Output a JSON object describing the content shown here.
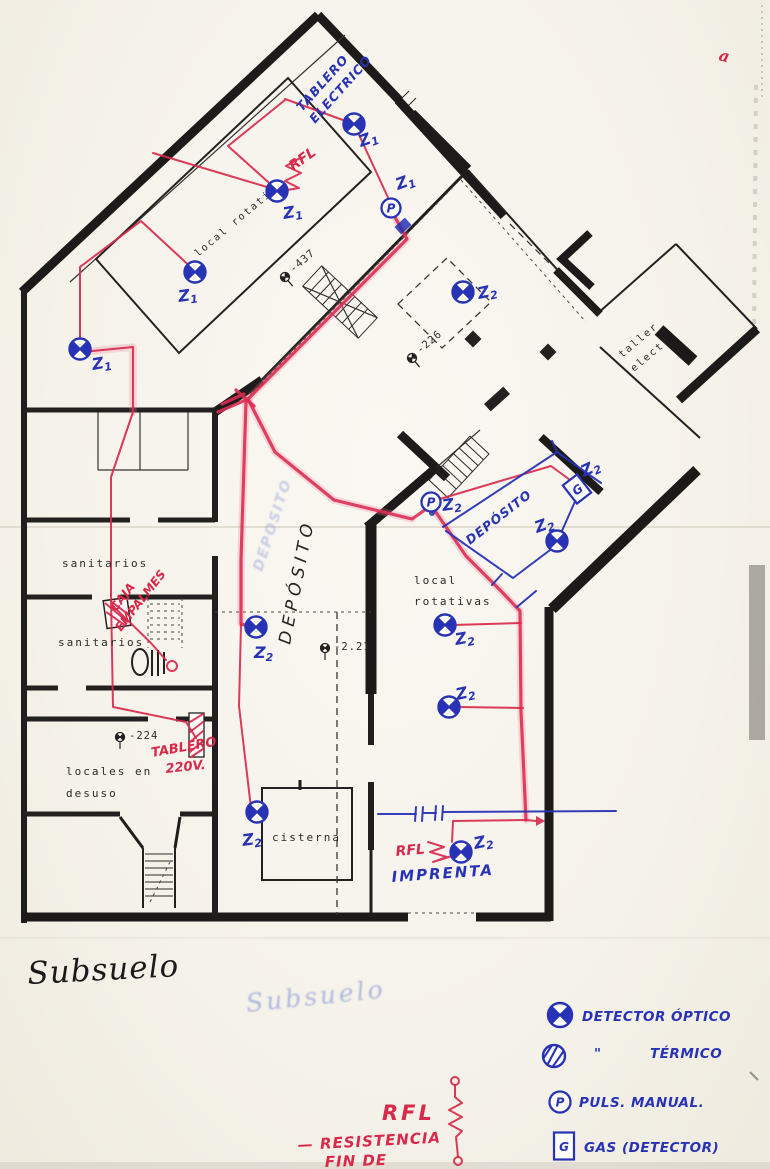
{
  "titles": {
    "main": "Subsuelo",
    "ghost": "Subsuelo",
    "corner_mark": "a"
  },
  "panel_notes": {
    "tablero_electrico_line1": "TABLERO",
    "tablero_electrico_line2": "ELECTRICO",
    "imprenta": "IMPRENTA",
    "deposito_blue": "DEPÓSITO",
    "deposito_black": "DEPÓSITO",
    "deposito_ghost": "DEPOSITO"
  },
  "rfl_note": {
    "symbol_label": "RFL",
    "line1": "— RESISTENCIA",
    "line2": "FIN DE"
  },
  "plan_labels": [
    {
      "text": "local rotativa",
      "x": 198,
      "y": 257,
      "rot": -40,
      "size": 10
    },
    {
      "text": "sanitarios",
      "x": 62,
      "y": 567,
      "size": 11
    },
    {
      "text": "sanitarios",
      "x": 58,
      "y": 646,
      "size": 11
    },
    {
      "text": "locales en",
      "x": 66,
      "y": 775,
      "size": 11
    },
    {
      "text": "desuso",
      "x": 66,
      "y": 797,
      "size": 11
    },
    {
      "text": "cisterna",
      "x": 272,
      "y": 841,
      "size": 11
    },
    {
      "text": "local",
      "x": 414,
      "y": 584,
      "size": 11
    },
    {
      "text": "rotativas",
      "x": 414,
      "y": 605,
      "size": 11
    },
    {
      "text": "taller",
      "x": 622,
      "y": 358,
      "rot": -40,
      "size": 10
    },
    {
      "text": "electr",
      "x": 634,
      "y": 372,
      "rot": -40,
      "size": 10
    }
  ],
  "level_markers": [
    {
      "text": "-437",
      "x": 285,
      "y": 277,
      "rot": -40
    },
    {
      "text": "-226",
      "x": 412,
      "y": 358,
      "rot": -40
    },
    {
      "text": "-2.21",
      "x": 325,
      "y": 648,
      "rot": 0
    },
    {
      "text": "-224",
      "x": 120,
      "y": 737,
      "rot": 0
    }
  ],
  "red_notes": [
    {
      "text": "RFL",
      "x": 293,
      "y": 171,
      "rot": -35,
      "size": 14
    },
    {
      "text": "CAJA",
      "x": 116,
      "y": 612,
      "rot": -52,
      "size": 12
    },
    {
      "text": "EMPALMES",
      "x": 121,
      "y": 632,
      "rot": -52,
      "size": 12
    },
    {
      "text": "TABLERO",
      "x": 152,
      "y": 757,
      "rot": -10,
      "size": 13
    },
    {
      "text": "220V.",
      "x": 166,
      "y": 773,
      "rot": -6,
      "size": 13
    },
    {
      "text": "RFL",
      "x": 396,
      "y": 856,
      "rot": -5,
      "size": 14
    }
  ],
  "detectors": [
    {
      "type": "optical",
      "zone": "Z1",
      "x": 354,
      "y": 124,
      "lx": 361,
      "ly": 147,
      "lrot": -20
    },
    {
      "type": "optical",
      "zone": "Z1",
      "x": 277,
      "y": 191,
      "lx": 284,
      "ly": 219,
      "lrot": -10
    },
    {
      "type": "optical",
      "zone": "Z1",
      "x": 195,
      "y": 272,
      "lx": 179,
      "ly": 302,
      "lrot": -8
    },
    {
      "type": "optical",
      "zone": "Z1",
      "x": 80,
      "y": 349,
      "lx": 93,
      "ly": 370,
      "lrot": -10
    },
    {
      "type": "pulsador",
      "zone": "Z1",
      "x": 391,
      "y": 208,
      "lx": 398,
      "ly": 190,
      "lrot": -20
    },
    {
      "type": "optical",
      "zone": "Z2",
      "x": 463,
      "y": 292,
      "lx": 479,
      "ly": 299,
      "lrot": -12
    },
    {
      "type": "pulsador",
      "zone": "Z2",
      "x": 431,
      "y": 502,
      "lx": 443,
      "ly": 511,
      "lrot": -8
    },
    {
      "type": "gas",
      "zone": "Z2",
      "x": 577,
      "y": 489,
      "rot": -38,
      "lx": 584,
      "ly": 477,
      "lrot": -25
    },
    {
      "type": "optical",
      "zone": "Z2",
      "x": 557,
      "y": 541,
      "lx": 537,
      "ly": 533,
      "lrot": -20
    },
    {
      "type": "optical",
      "zone": "Z2",
      "x": 256,
      "y": 627,
      "lx": 254,
      "ly": 658,
      "lrot": 0
    },
    {
      "type": "optical",
      "zone": "Z2",
      "x": 445,
      "y": 625,
      "lx": 456,
      "ly": 645,
      "lrot": -10
    },
    {
      "type": "optical",
      "zone": "Z2",
      "x": 449,
      "y": 707,
      "lx": 457,
      "ly": 700,
      "lrot": -12
    },
    {
      "type": "optical",
      "zone": "Z2",
      "x": 257,
      "y": 812,
      "lx": 243,
      "ly": 846,
      "lrot": -8
    },
    {
      "type": "optical",
      "zone": "Z2",
      "x": 461,
      "y": 852,
      "lx": 475,
      "ly": 849,
      "lrot": -12
    }
  ],
  "legend": {
    "items": [
      {
        "symbol": "optical",
        "label": "DETECTOR ÓPTICO",
        "x": 560,
        "y": 1015,
        "label_x": 582,
        "label_y": 1021
      },
      {
        "symbol": "thermal",
        "ditto": "\"",
        "ditto_x": 594,
        "ditto_y": 1058,
        "label": "TÉRMICO",
        "x": 554,
        "y": 1056,
        "label_x": 650,
        "label_y": 1058
      },
      {
        "symbol": "pulsador",
        "label": "PULS. MANUAL.",
        "x": 560,
        "y": 1102,
        "label_x": 579,
        "label_y": 1107
      },
      {
        "symbol": "gas",
        "label": "GAS (DETECTOR)",
        "x": 564,
        "y": 1146,
        "label_x": 584,
        "label_y": 1152
      }
    ]
  },
  "colors": {
    "ink_red": "#d8294b",
    "ink_blue": "#2733b4",
    "wall": "#1d1b19",
    "paper": "#f6f3ec"
  }
}
